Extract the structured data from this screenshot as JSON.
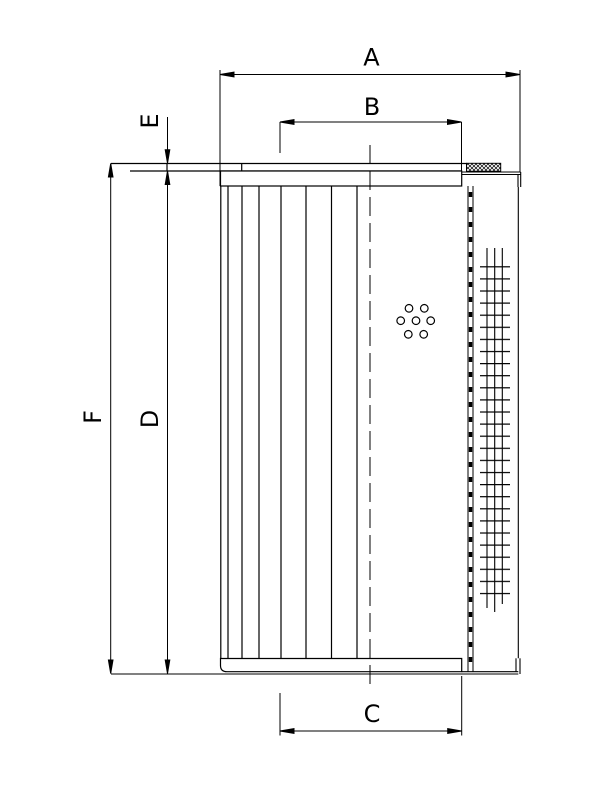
{
  "drawing": {
    "type": "technical-drawing-filter-element",
    "colors": {
      "line": "#000000",
      "background": "#ffffff"
    }
  },
  "labels": {
    "a": "A",
    "b": "B",
    "c": "C",
    "d": "D",
    "e": "E",
    "f": "F"
  }
}
